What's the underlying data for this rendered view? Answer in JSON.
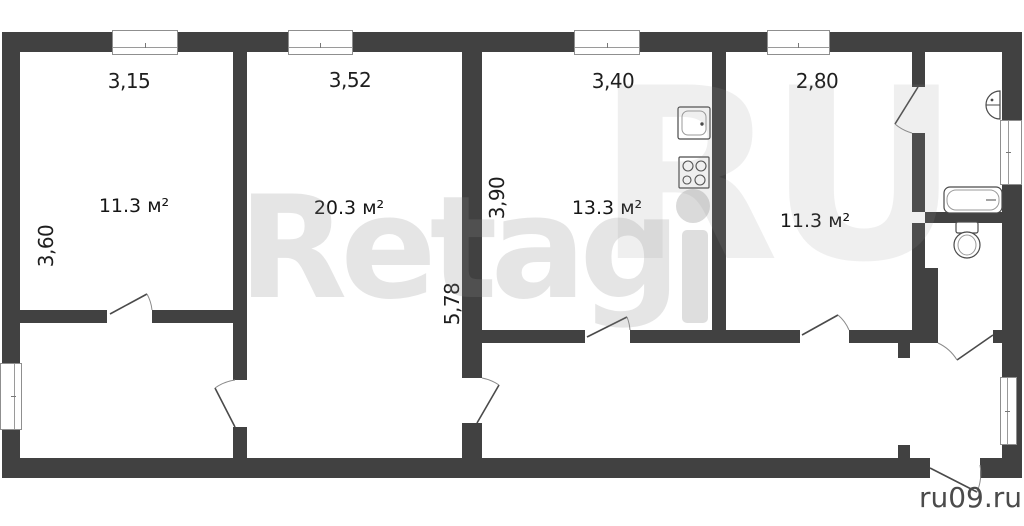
{
  "watermark": {
    "brand": "Retag",
    "brand_suffix": "RU",
    "site": "ru09.ru"
  },
  "dimensions": {
    "room1_width": "3,15",
    "room2_width": "3,52",
    "kitchen_width": "3,40",
    "room4_width": "2,80",
    "room1_height": "3,60",
    "kitchen_height": "3,90",
    "room2_height": "5,78"
  },
  "areas": {
    "room1": "11.3 м²",
    "room2": "20.3 м²",
    "kitchen": "13.3 м²",
    "room4": "11.3 м²"
  },
  "colors": {
    "wall": "#414141",
    "fixture_outline": "#4a4a4a",
    "label": "#1e1e1e",
    "watermark": "#e2e2e2",
    "site_label": "#4b4b4b"
  }
}
